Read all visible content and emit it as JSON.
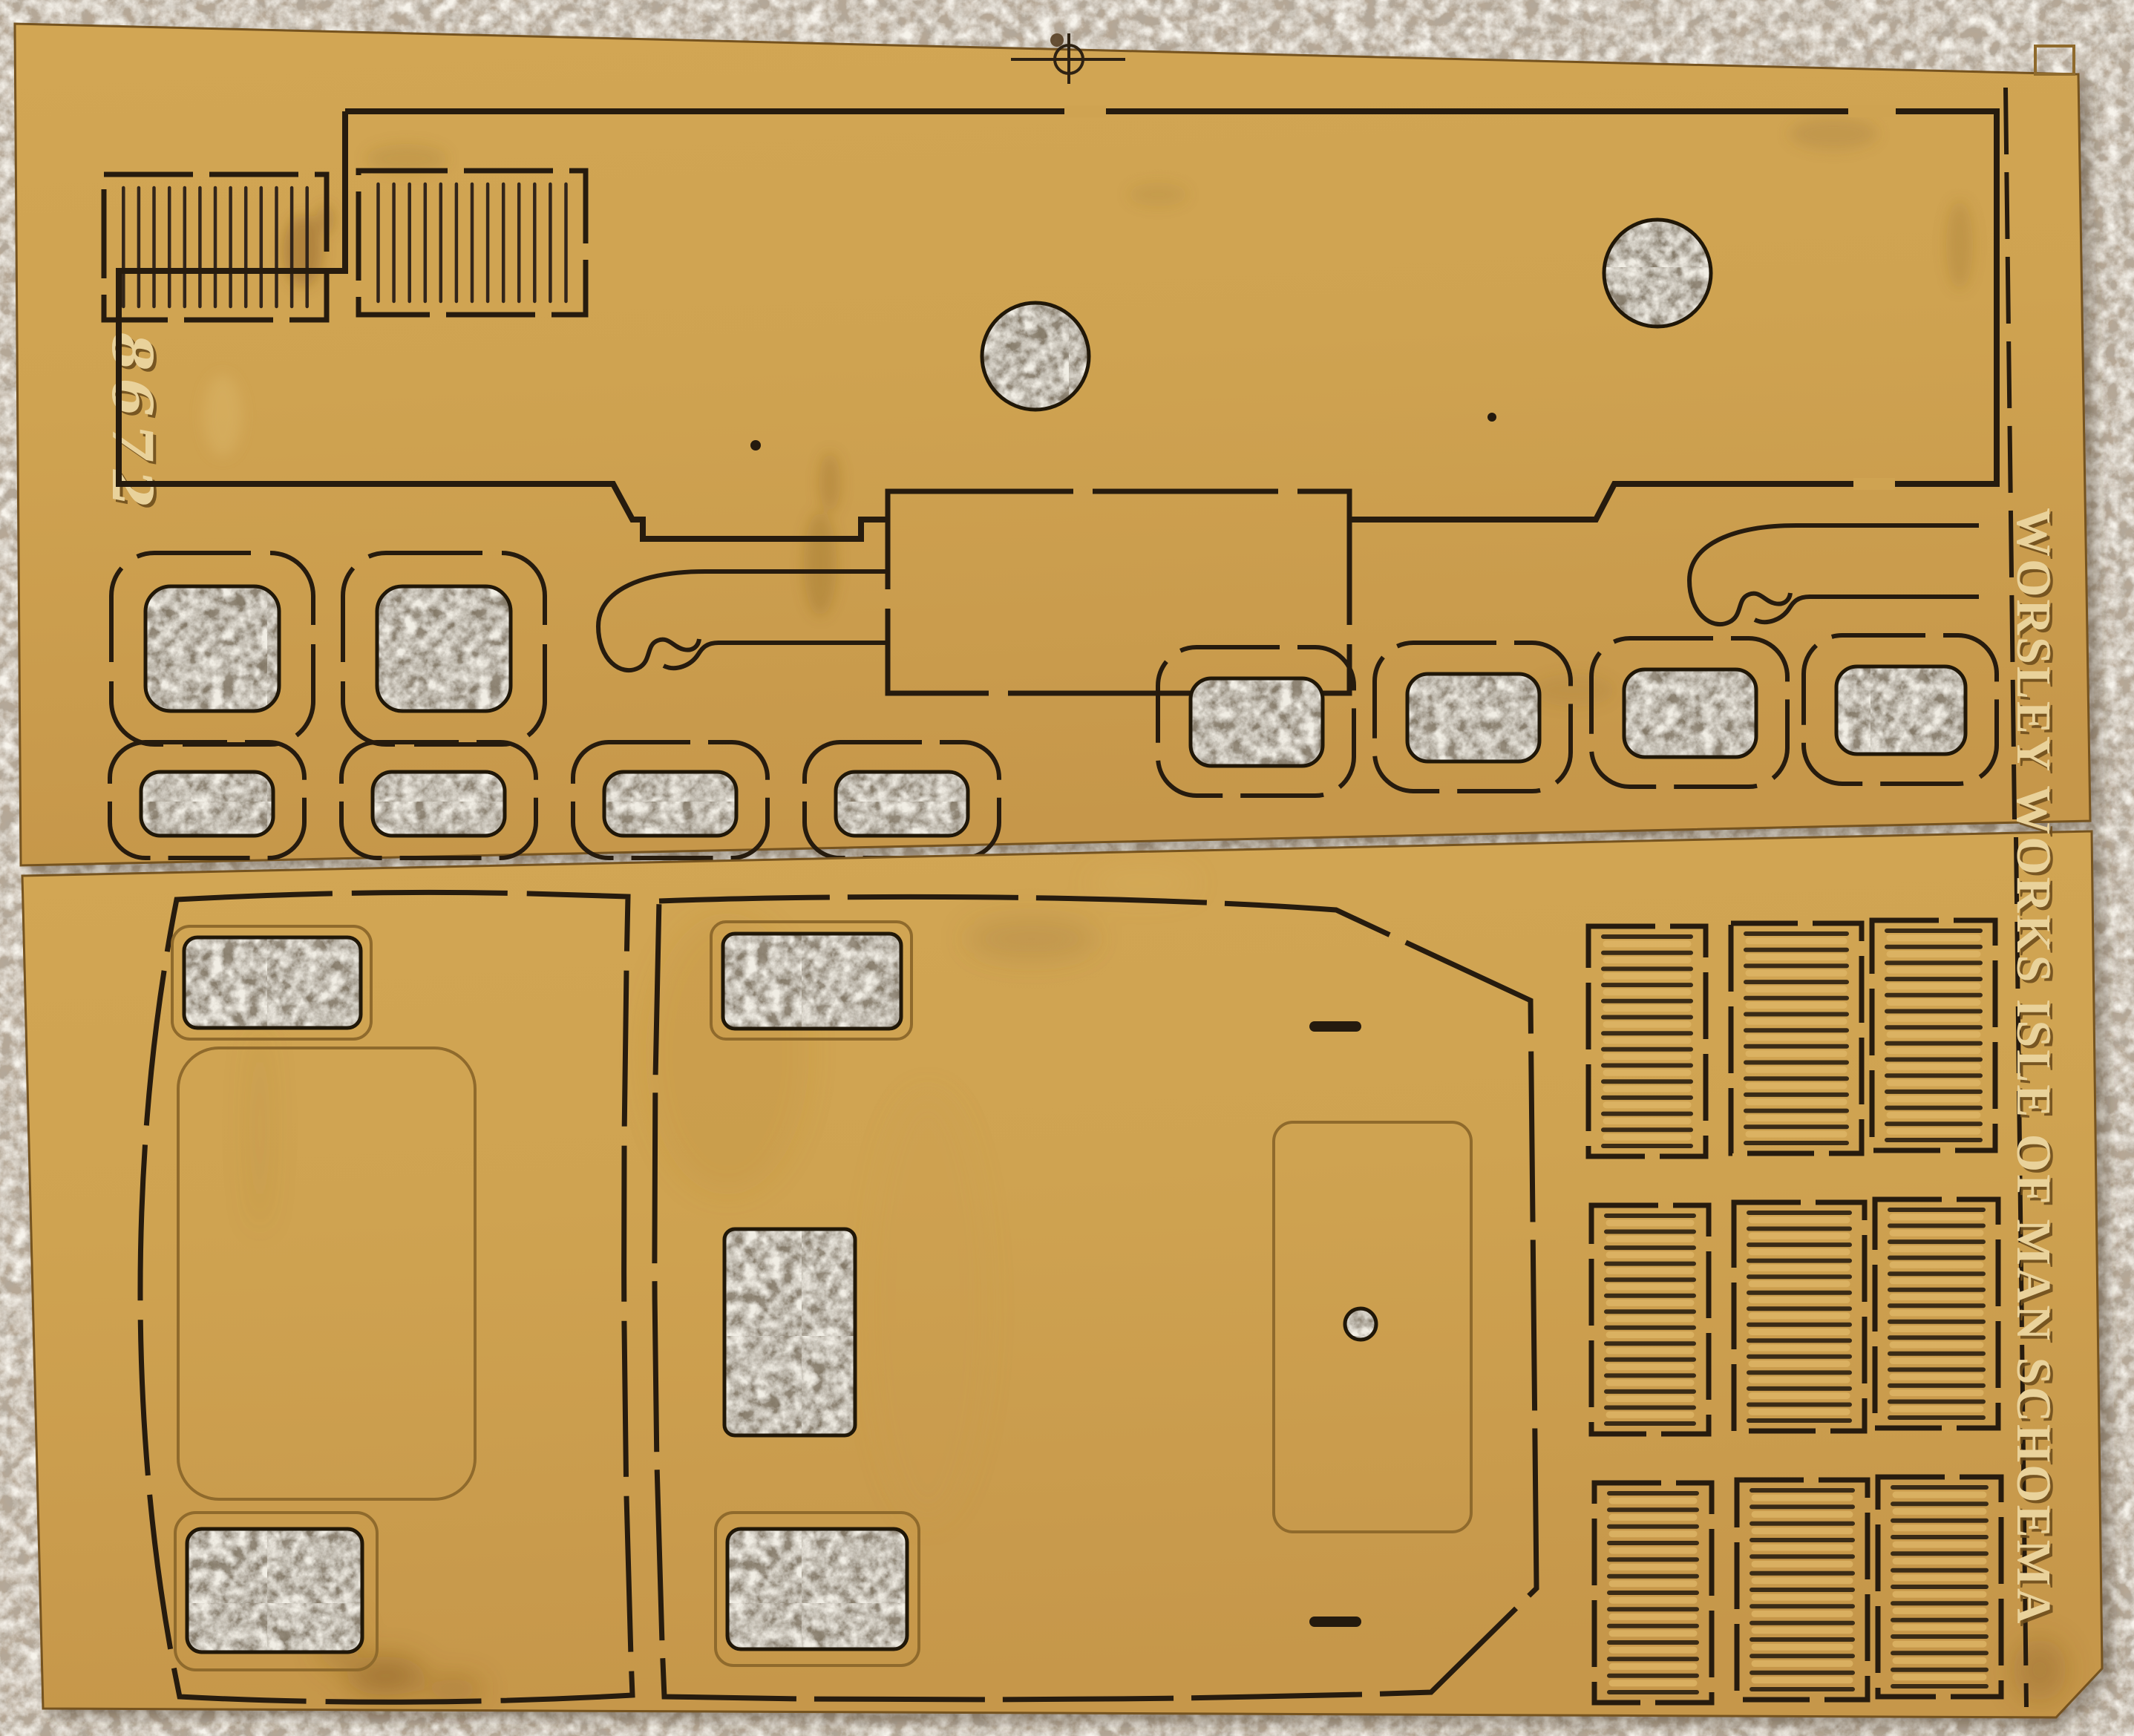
{
  "scene": {
    "type": "photograph",
    "subject": "etched-brass model railway kit fret lying on beige carpet",
    "etched_text": "WORSLEY WORKS ISLE OF MAN SCHOEMA",
    "handwritten_number": "8672",
    "colors": {
      "brass_sheet": "#cfa351",
      "brass_light": "#dcb264",
      "brass_shadow": "#b8893f",
      "cut_line": "#261b0e",
      "engraving": "#8f6a2c",
      "carpet": "#b6a795",
      "carpet_in_holes": "#847968",
      "emboss_highlight": "#e9d29b",
      "emboss_shadow": "#6e4e1d"
    },
    "fret_features": {
      "upper_louvre_panels": 2,
      "round_holes": 2,
      "pin_holes": 2,
      "coupling_hooks": 2,
      "large_window_frames": 2,
      "small_window_frames": 8,
      "cab_side_panels": 2,
      "louvre_grid_rows": 3,
      "louvre_grid_columns": 3,
      "registration_mark": "crosshair"
    }
  }
}
